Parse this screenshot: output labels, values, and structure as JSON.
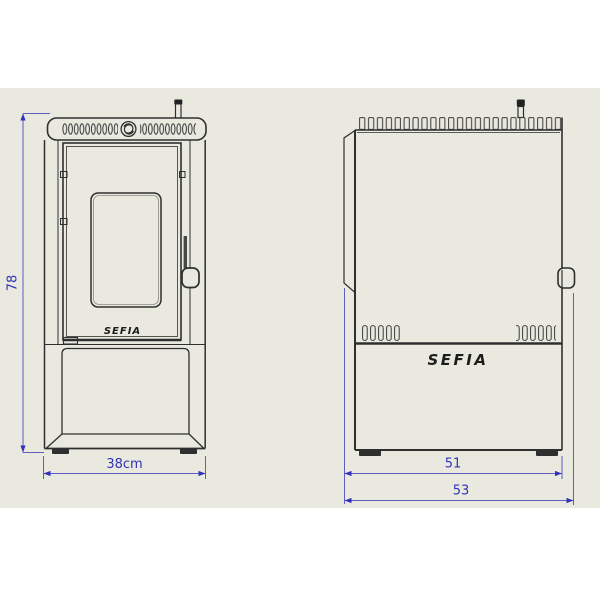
{
  "product_drawing": {
    "brand": "SEFIA",
    "views": {
      "front": "front-view",
      "side": "side-view"
    },
    "dimensions": {
      "height": "78",
      "width": "38cm",
      "depth_body": "51",
      "depth_overall": "53"
    },
    "colors": {
      "sheet_background": "#e9e9e0",
      "drawing_line": "#2f2f2f",
      "dimension_line": "#5d5dc5",
      "dimension_text": "#3232b8",
      "foot_fill": "#2f2f2f"
    }
  }
}
